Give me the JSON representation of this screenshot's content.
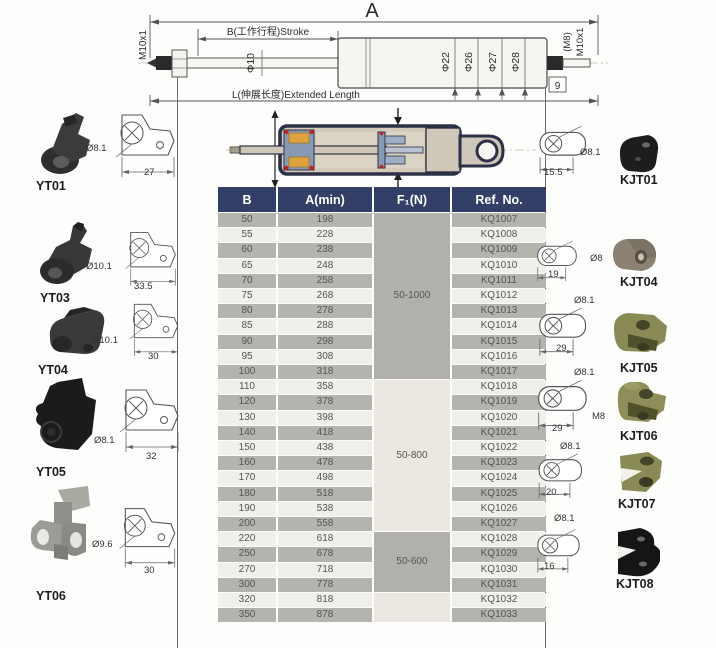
{
  "diagram": {
    "dim_a_label": "A",
    "stroke_label": "B(工作行程)Stroke",
    "extended_length_label": "L(伸展长度)Extended Length",
    "left_thread_label": "M10x1",
    "rod_diameter_label": "Φ10",
    "body_diameter_labels": [
      "Φ22",
      "Φ26",
      "Φ27",
      "Φ28"
    ],
    "right_thread_m8_label": "(M8)",
    "right_thread_label": "M10x1",
    "right_end_dim": "9"
  },
  "table": {
    "headers": [
      "B",
      "A(min)",
      "F₁(N)",
      "Ref. No."
    ],
    "force_groups": [
      {
        "label": "50-1000",
        "rows": 11
      },
      {
        "label": "50-800",
        "rows": 10
      },
      {
        "label": "50-600",
        "rows": 4
      },
      {
        "label": "",
        "rows": 2
      }
    ],
    "rows": [
      [
        "50",
        "198",
        "KQ1007"
      ],
      [
        "55",
        "228",
        "KQ1008"
      ],
      [
        "60",
        "238",
        "KQ1009"
      ],
      [
        "65",
        "248",
        "KQ1010"
      ],
      [
        "70",
        "258",
        "KQ1011"
      ],
      [
        "75",
        "268",
        "KQ1012"
      ],
      [
        "80",
        "278",
        "KQ1013"
      ],
      [
        "85",
        "288",
        "KQ1014"
      ],
      [
        "90",
        "298",
        "KQ1015"
      ],
      [
        "95",
        "308",
        "KQ1016"
      ],
      [
        "100",
        "318",
        "KQ1017"
      ],
      [
        "110",
        "358",
        "KQ1018"
      ],
      [
        "120",
        "378",
        "KQ1019"
      ],
      [
        "130",
        "398",
        "KQ1020"
      ],
      [
        "140",
        "418",
        "KQ1021"
      ],
      [
        "150",
        "438",
        "KQ1022"
      ],
      [
        "160",
        "478",
        "KQ1023"
      ],
      [
        "170",
        "498",
        "KQ1024"
      ],
      [
        "180",
        "518",
        "KQ1025"
      ],
      [
        "190",
        "538",
        "KQ1026"
      ],
      [
        "200",
        "558",
        "KQ1027"
      ],
      [
        "220",
        "618",
        "KQ1028"
      ],
      [
        "250",
        "678",
        "KQ1029"
      ],
      [
        "270",
        "718",
        "KQ1030"
      ],
      [
        "300",
        "778",
        "KQ1031"
      ],
      [
        "320",
        "818",
        "KQ1032"
      ],
      [
        "350",
        "878",
        "KQ1033"
      ]
    ]
  },
  "left_fittings": [
    {
      "name": "YT01",
      "dia": "Ø8.1",
      "width": "27"
    },
    {
      "name": "YT03",
      "dia": "Ø10.1",
      "width": "33.5"
    },
    {
      "name": "YT04",
      "dia": "Ø10.1",
      "width": "30"
    },
    {
      "name": "YT05",
      "dia": "Ø8.1",
      "width": "32"
    },
    {
      "name": "YT06",
      "dia": "Ø9.6",
      "width": "30"
    }
  ],
  "right_fittings": [
    {
      "name": "KJT01",
      "dia": "Ø8.1",
      "width": "15.5"
    },
    {
      "name": "KJT04",
      "dia": "Ø8",
      "width": "19"
    },
    {
      "name": "KJT05",
      "dia": "Ø8.1",
      "width": "29"
    },
    {
      "name": "KJT06",
      "dia": "Ø8.1",
      "width": "29",
      "thread": "M8"
    },
    {
      "name": "KJT07",
      "dia": "Ø8.1",
      "width": "20"
    },
    {
      "name": "KJT08",
      "dia": "Ø8.1",
      "width": "16"
    }
  ],
  "colors": {
    "table_header": "#333f66",
    "row_gray": "#b5b3ae",
    "row_light": "#f1efe9",
    "section_body": "#d3caba",
    "section_outline": "#2d3147",
    "seal_orange": "#dfa23f",
    "seal_red": "#c22222",
    "gland_blue": "#8899b4",
    "olive_fitting": "#8a8a56"
  }
}
